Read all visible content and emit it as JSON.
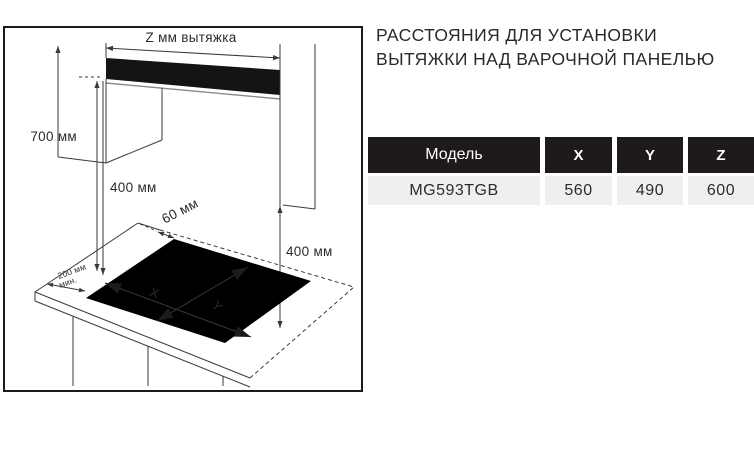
{
  "title": {
    "line1": "РАССТОЯНИЯ ДЛЯ УСТАНОВКИ",
    "line2": "ВЫТЯЖКИ НАД ВАРОЧНОЙ ПАНЕЛЬЮ"
  },
  "diagram": {
    "hood_width_label": "Z мм вытяжка",
    "height_700": "700 мм",
    "height_400_left": "400 мм",
    "height_400_right": "400 мм",
    "gap_60": "60 мм",
    "side_200_line1": "200 мм",
    "side_200_line2": "мин.",
    "cutout_width_label": "X",
    "cutout_depth_label": "Y"
  },
  "table": {
    "headers": [
      "Модель",
      "X",
      "Y",
      "Z"
    ],
    "rows": [
      {
        "model": "MG593TGB",
        "x": "560",
        "y": "490",
        "z": "600"
      }
    ]
  },
  "colors": {
    "header_bg": "#1d1a19",
    "row_bg": "#efefef",
    "line": "#3a3a3a",
    "text": "#2b2b2b"
  }
}
